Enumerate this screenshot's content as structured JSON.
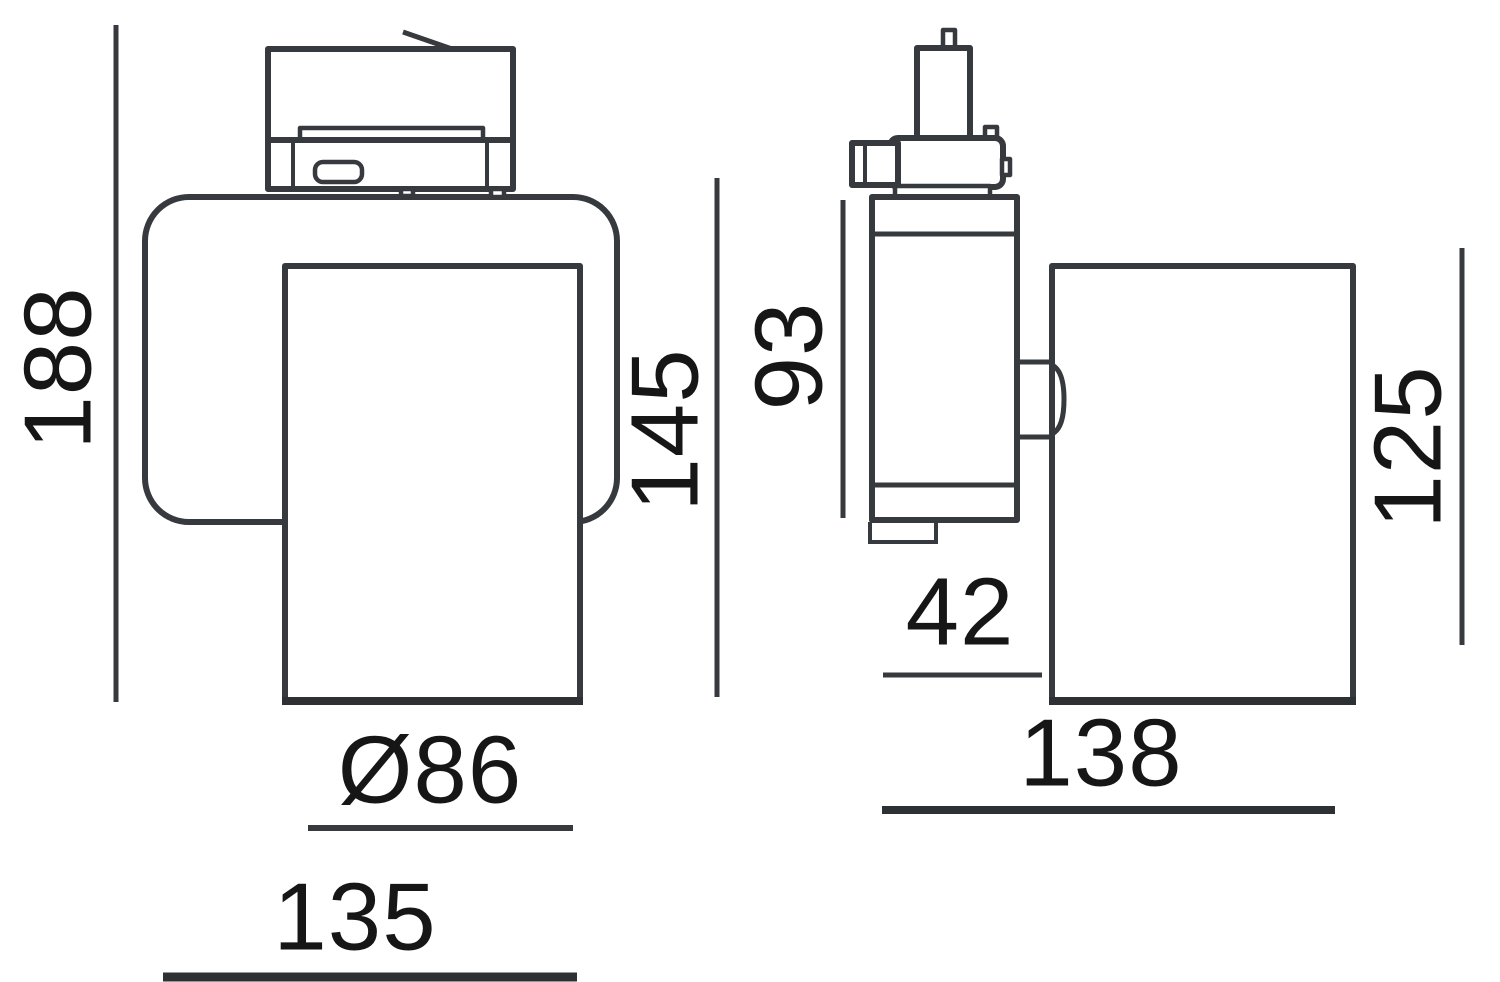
{
  "drawing": {
    "kind": "technical-dimension-drawing",
    "colors": {
      "line": "#36393d",
      "text": "#161616",
      "background": "#ffffff"
    },
    "front_view": {
      "overall_height": "188",
      "body_height": "145",
      "head_diameter": "Ø86",
      "overall_width": "135"
    },
    "side_view": {
      "adapter_body_height": "93",
      "body_depth": "42",
      "head_height": "125",
      "head_length": "138"
    }
  }
}
